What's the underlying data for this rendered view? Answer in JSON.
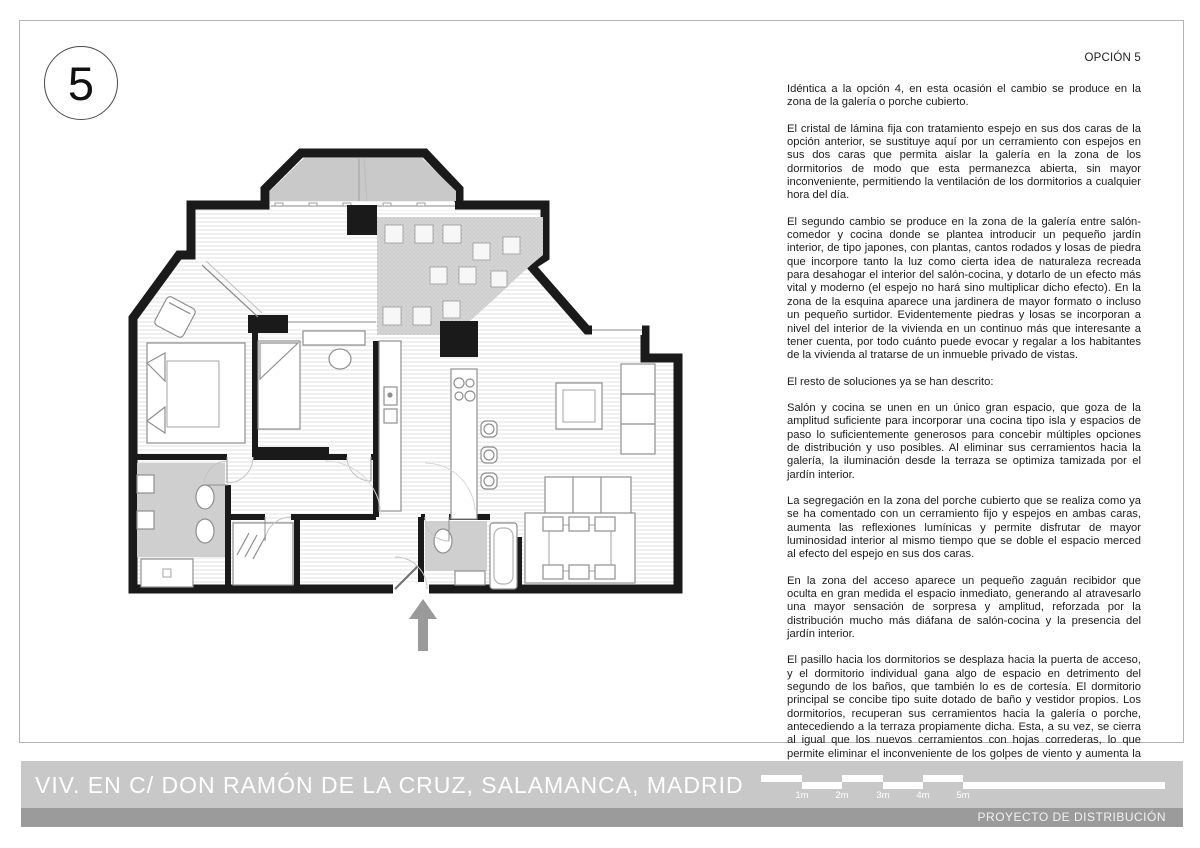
{
  "page": {
    "number_badge": "5",
    "option_label": "OPCIÓN 5"
  },
  "description": {
    "paragraphs": [
      "Idéntica a la opción 4, en esta ocasión el cambio se produce en la zona de la galería o porche cubierto.",
      "El cristal de lámina fija con tratamiento espejo en sus dos caras de la opción anterior, se sustituye aquí por un cerramiento con espejos en sus dos caras que permita aislar la galería en la zona de los dormitorios de modo que esta permanezca abierta, sin mayor inconveniente, permitiendo la ventilación de los dormitorios a cualquier hora del día.",
      "El segundo cambio se produce en la zona de la galería entre salón-comedor y cocina donde se plantea introducir un pequeño jardín interior, de tipo japones, con plantas, cantos rodados y losas de piedra que incorpore tanto la luz como cierta idea de naturaleza recreada para desahogar el interior del salón-cocina, y dotarlo de un efecto más vital y moderno (el espejo no hará sino multiplicar dicho efecto). En la zona de la esquina aparece una jardinera de mayor formato o incluso un pequeño surtidor. Evidentemente piedras y losas se incorporan a nivel del interior de la vivienda en un continuo más que interesante a tener cuenta, por todo cuánto puede evocar y regalar a los habitantes de la vivienda al tratarse de un inmueble privado de vistas.",
      "El resto de soluciones ya se han descrito:",
      "Salón y cocina se unen en un único gran espacio, que goza de la amplitud suficiente para incorporar una cocina tipo isla y espacios de paso lo suficientemente generosos para concebir múltiples opciones de distribución y uso posibles. Al eliminar sus cerramientos hacia la galería, la iluminación desde la terraza se optimiza tamizada por el jardín interior.",
      "La segregación en la zona del porche cubierto que se realiza como ya se ha comentado con un cerramiento fijo y espejos en ambas caras, aumenta las reflexiones lumínicas y permite disfrutar de mayor luminosidad interior al mismo tiempo que se doble el espacio merced al efecto del espejo en sus dos caras.",
      "En la zona del acceso aparece un pequeño zaguán recibidor que oculta en gran medida el espacio inmediato, generando al atravesarlo una mayor sensación de sorpresa y amplitud, reforzada por la distribución mucho más diáfana de salón-cocina y la presencia del jardín interior.",
      "El pasillo hacia los dormitorios se desplaza hacia la puerta de acceso, y el dormitorio individual gana algo de espacio en detrimento del segundo de los baños, que también lo es de cortesía. El dormitorio principal se concibe tipo suite dotado de baño y vestidor propios. Los dormitorios, recuperan sus cerramientos hacia la galería o porche, antecediendo a la terraza propiamente dicha. Esta, a su vez, se cierra al igual que los nuevos cerramientos con hojas correderas, lo que permite eliminar el inconveniente de los golpes de viento y aumenta la superficie útil a su alrededor."
    ]
  },
  "footer": {
    "project_title": "VIV. EN C/ DON RAMÓN DE LA CRUZ, SALAMANCA, MADRID",
    "project_subtitle": "PROYECTO DE DISTRIBUCIÓN",
    "scale_labels": [
      "1m",
      "2m",
      "3m",
      "4m",
      "5m"
    ]
  },
  "colors": {
    "wall": "#1a1a1a",
    "band_light": "#c8c8c8",
    "band_dark": "#9b9b9b",
    "bay_fill": "#c9c9c9",
    "garden_fill": "#d6d6d6",
    "bath_fill": "#cfcfcf",
    "arrow": "#9a9a9a",
    "frame_line": "#b4b4b4"
  }
}
